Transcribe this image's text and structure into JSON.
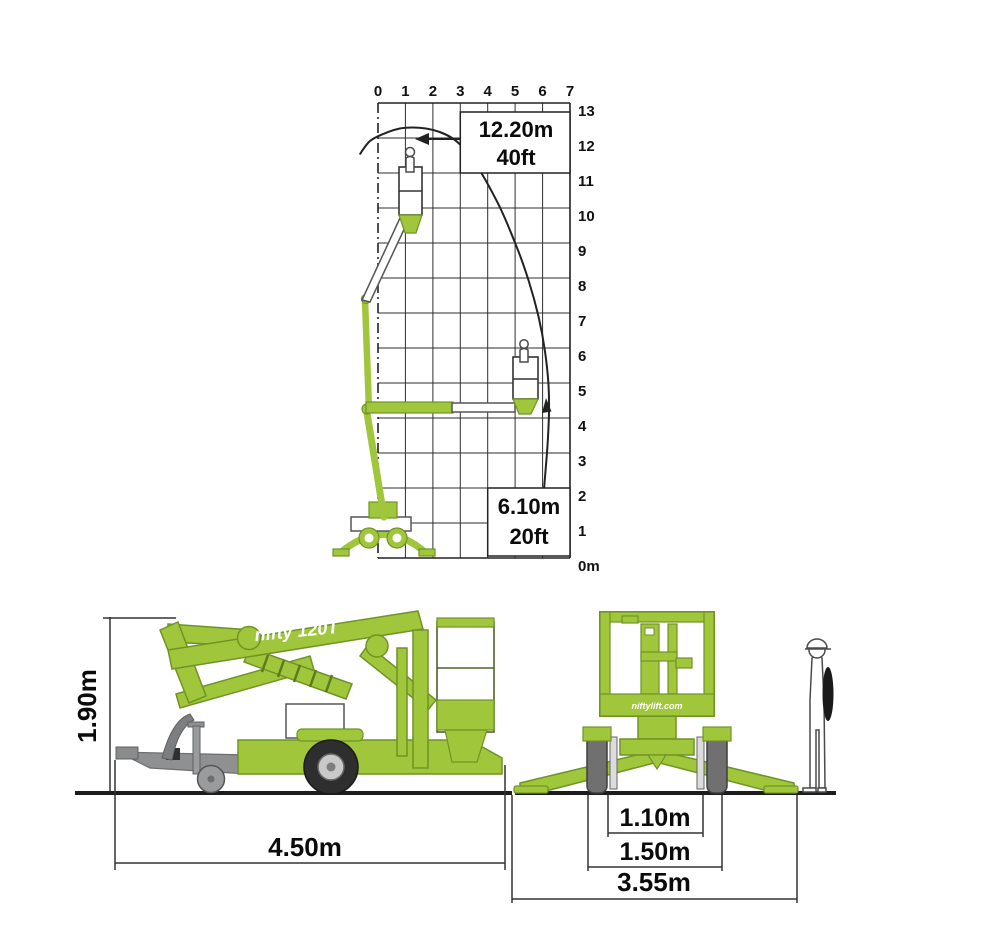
{
  "meta": {
    "description": "Niftylift 120T trailer mounted boom lift: working envelope chart (top) and stowed dimension drawings, side and rear views (bottom)."
  },
  "colors": {
    "machine_green": "#A0C63C",
    "machine_green_outline": "#6F9425",
    "diagram_line": "#222222",
    "drawbar_grey": "#8F9091",
    "tire_dark": "#2E2E2E",
    "background": "#FFFFFF"
  },
  "envelope_chart": {
    "x_ticks": [
      "0",
      "1",
      "2",
      "3",
      "4",
      "5",
      "6",
      "7"
    ],
    "y_ticks": [
      "13",
      "12",
      "11",
      "10",
      "9",
      "8",
      "7",
      "6",
      "5",
      "4",
      "3",
      "2",
      "1",
      "0m"
    ],
    "height_label_lines": [
      "12.20m",
      "40ft"
    ],
    "outreach_label_lines": [
      "6.10m",
      "20ft"
    ]
  },
  "side_view": {
    "brand_text": "nifty 120T",
    "height_label": "1.90m",
    "length_label": "4.50m"
  },
  "rear_view": {
    "brand_text": "niftylift.com",
    "track_label": "1.10m",
    "width_label": "1.50m",
    "outrigger_label": "3.55m"
  },
  "chart_data": {
    "type": "line",
    "title": "Working envelope (platform height vs outreach)",
    "x_axis": {
      "range": [
        0,
        7
      ],
      "ticks": [
        0,
        1,
        2,
        3,
        4,
        5,
        6,
        7
      ],
      "unit": "m"
    },
    "y_axis": {
      "range": [
        0,
        13
      ],
      "ticks": [
        13,
        12,
        11,
        10,
        9,
        8,
        7,
        6,
        5,
        4,
        3,
        2,
        1,
        0
      ],
      "unit": "m"
    },
    "grid": true,
    "legend": false,
    "series": [
      {
        "name": "working-envelope-boundary",
        "points": [
          [
            -0.65,
            11.55
          ],
          [
            -0.4,
            11.85
          ],
          [
            -0.15,
            12.0
          ],
          [
            0.2,
            12.12
          ],
          [
            0.6,
            12.24
          ],
          [
            1.0,
            12.3
          ],
          [
            1.5,
            12.3
          ],
          [
            2.0,
            12.24
          ],
          [
            2.5,
            12.1
          ],
          [
            2.9,
            11.9
          ],
          [
            3.3,
            11.55
          ],
          [
            3.7,
            11.1
          ],
          [
            4.1,
            10.55
          ],
          [
            4.5,
            9.95
          ],
          [
            4.9,
            9.2
          ],
          [
            5.3,
            8.4
          ],
          [
            5.7,
            7.4
          ],
          [
            6.0,
            6.4
          ],
          [
            6.18,
            5.4
          ],
          [
            6.25,
            4.5
          ],
          [
            6.2,
            3.4
          ],
          [
            6.1,
            2.4
          ],
          [
            6.05,
            1.95
          ]
        ]
      }
    ],
    "annotations": [
      {
        "label_lines": [
          "12.20m",
          "40ft"
        ],
        "value_m": 12.2,
        "position": "top-right"
      },
      {
        "label_lines": [
          "6.10m",
          "20ft"
        ],
        "value_m": 6.1,
        "position": "bottom-right"
      }
    ]
  }
}
